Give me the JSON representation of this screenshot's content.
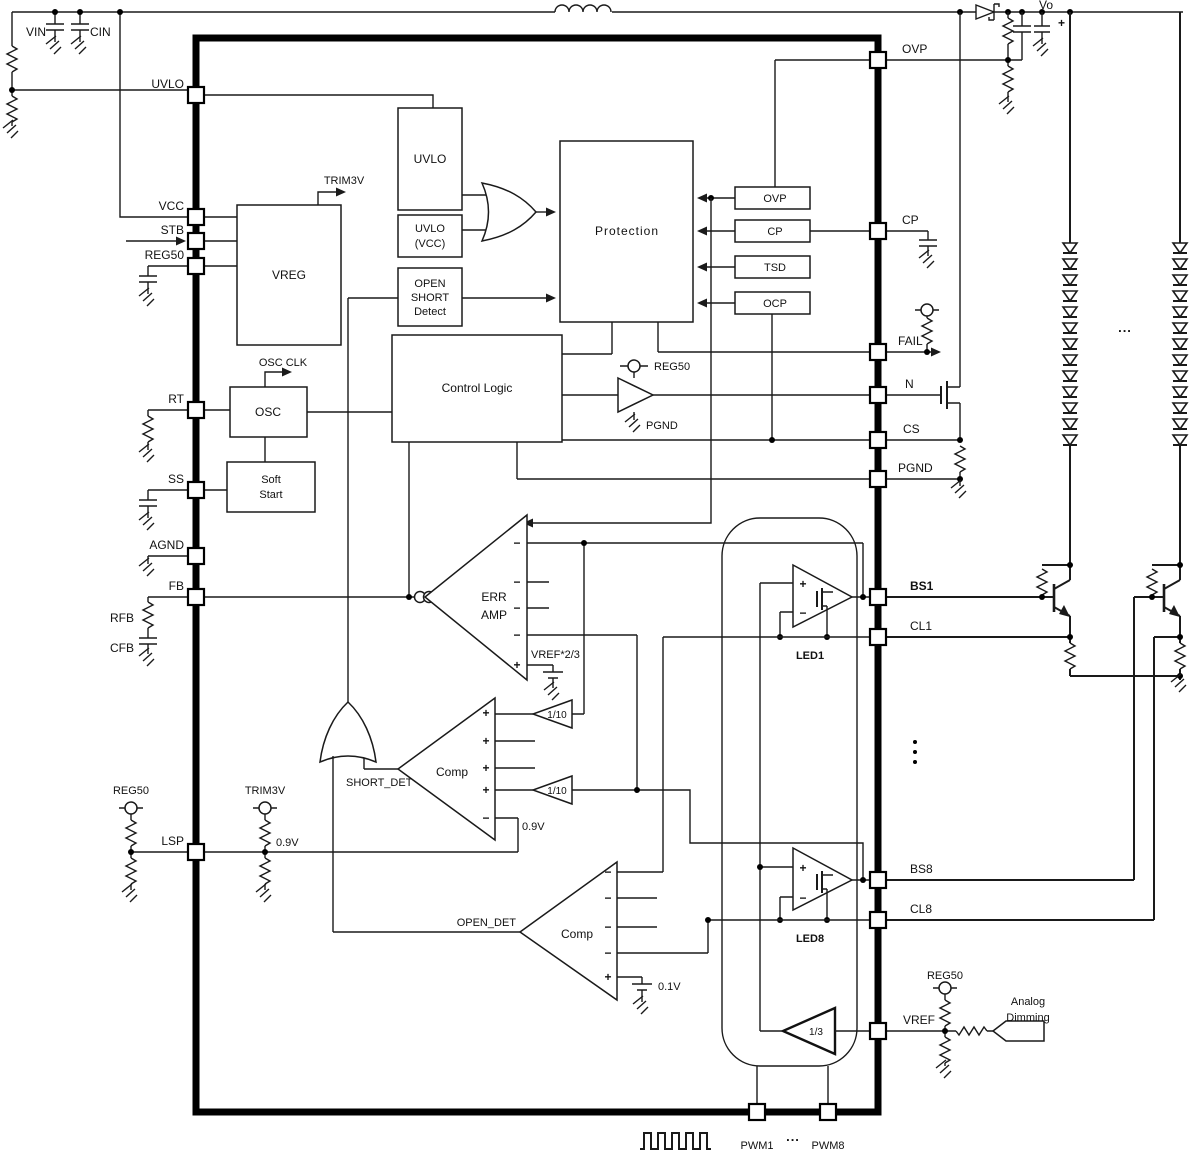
{
  "diagram": {
    "pins": {
      "left": [
        "UVLO",
        "VCC",
        "STB",
        "REG50",
        "RT",
        "SS",
        "AGND",
        "FB",
        "LSP"
      ],
      "right": [
        "OVP",
        "CP",
        "FAIL",
        "N",
        "CS",
        "PGND",
        "BS1",
        "CL1",
        "BS8",
        "CL8",
        "VREF"
      ],
      "bottom": [
        "PWM1",
        "PWM8"
      ]
    },
    "blocks": {
      "vreg": "VREG",
      "uvlo": "UVLO",
      "uvlo_vcc": [
        "UVLO",
        "(VCC)"
      ],
      "open_short_detect": [
        "OPEN",
        "SHORT",
        "Detect"
      ],
      "protection": "Protection",
      "control_logic": "Control Logic",
      "osc": "OSC",
      "soft_start": [
        "Soft",
        "Start"
      ],
      "flags": [
        "OVP",
        "CP",
        "TSD",
        "OCP"
      ]
    },
    "amps": {
      "err_amp": [
        "ERR",
        "AMP"
      ],
      "comp_short": "Comp",
      "comp_open": "Comp",
      "gain_tenth": "1/10",
      "gain_third": "1/3",
      "led1": "LED1",
      "led8": "LED8"
    },
    "signals": {
      "trim3v": "TRIM3V",
      "osc_clk": "OSC CLK",
      "reg50": "REG50",
      "pgnd": "PGND",
      "short_det": "SHORT_DET",
      "open_det": "OPEN_DET",
      "vref_two_thirds": "VREF*2/3",
      "v09": "0.9V",
      "v01": "0.1V",
      "plus": "+",
      "minus": "−"
    },
    "external": {
      "vin": "VIN",
      "cin": "CIN",
      "vo": "Vo",
      "rfb": "RFB",
      "cfb": "CFB",
      "analog_dimming": [
        "Analog",
        "Dimming"
      ]
    },
    "ellipsis": "..."
  }
}
